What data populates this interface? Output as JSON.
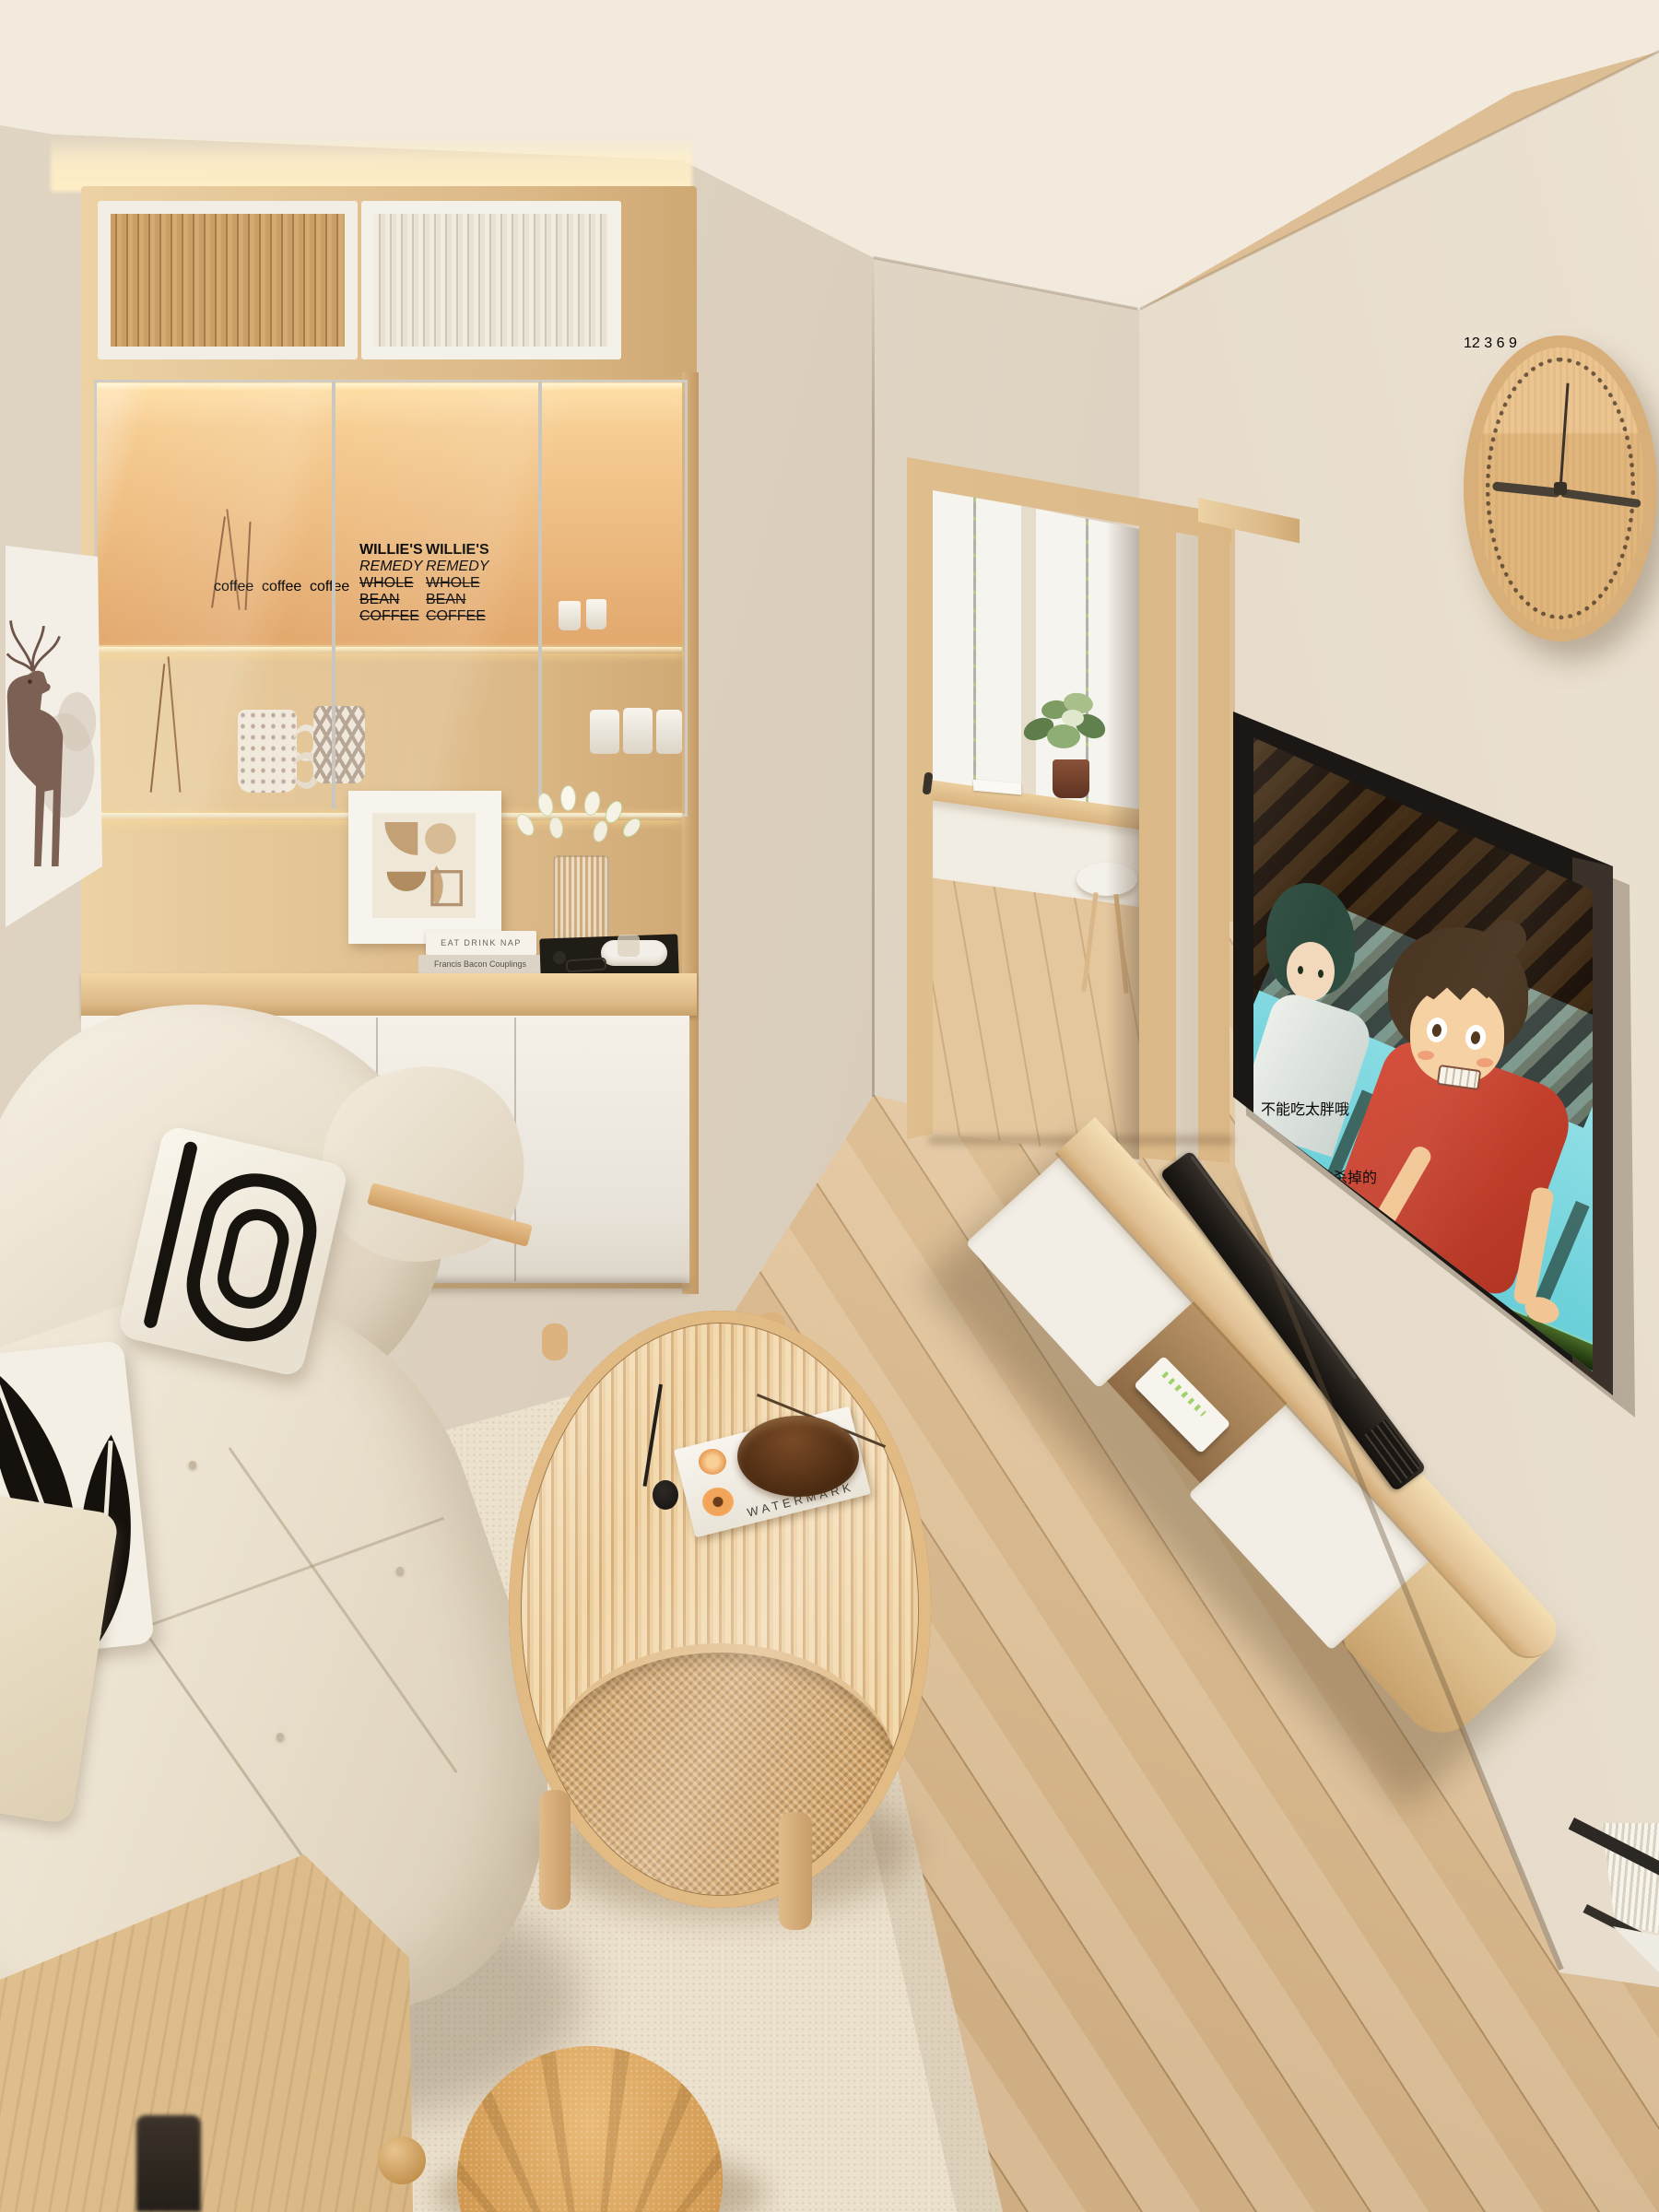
{
  "scene": {
    "type": "interior-render",
    "style": "japandi-living-room",
    "clock": {
      "numeral_top": "12",
      "numeral_right": "3",
      "numeral_bottom": "6",
      "numeral_left": "9",
      "time_shown": "9:15"
    },
    "tv": {
      "content": "Spirited Away scene, Haku and Chihiro at a green railing",
      "subtitle_1": "不能吃太胖哦",
      "subtitle_2": "会被杀掉的"
    },
    "cabinet": {
      "coffee_bag_label": "coffee",
      "coffee_box": {
        "brand": "WILLIE'S",
        "name": "REMEDY",
        "line1": "WHOLE BEAN",
        "line2": "COFFEE"
      },
      "shelf_books": {
        "book1": "EAT DRINK NAP",
        "book2": "Francis Bacon Couplings"
      }
    },
    "coffee_table": {
      "book_title": "WATERMARK"
    },
    "palette": {
      "wall": "#e2d7c6",
      "ceiling": "#efe8db",
      "wood_light": "#e6c897",
      "floor": "#dcbf98",
      "sofa": "#ece3d3",
      "rug": "#ece1cd",
      "tv_frame": "#1c1916",
      "screen_sky": "#7fd8e0",
      "shirt_red": "#cc4433",
      "railing_green": "#2c4418",
      "soundbar": "#242019",
      "clock_wood": "#dcb684"
    }
  }
}
